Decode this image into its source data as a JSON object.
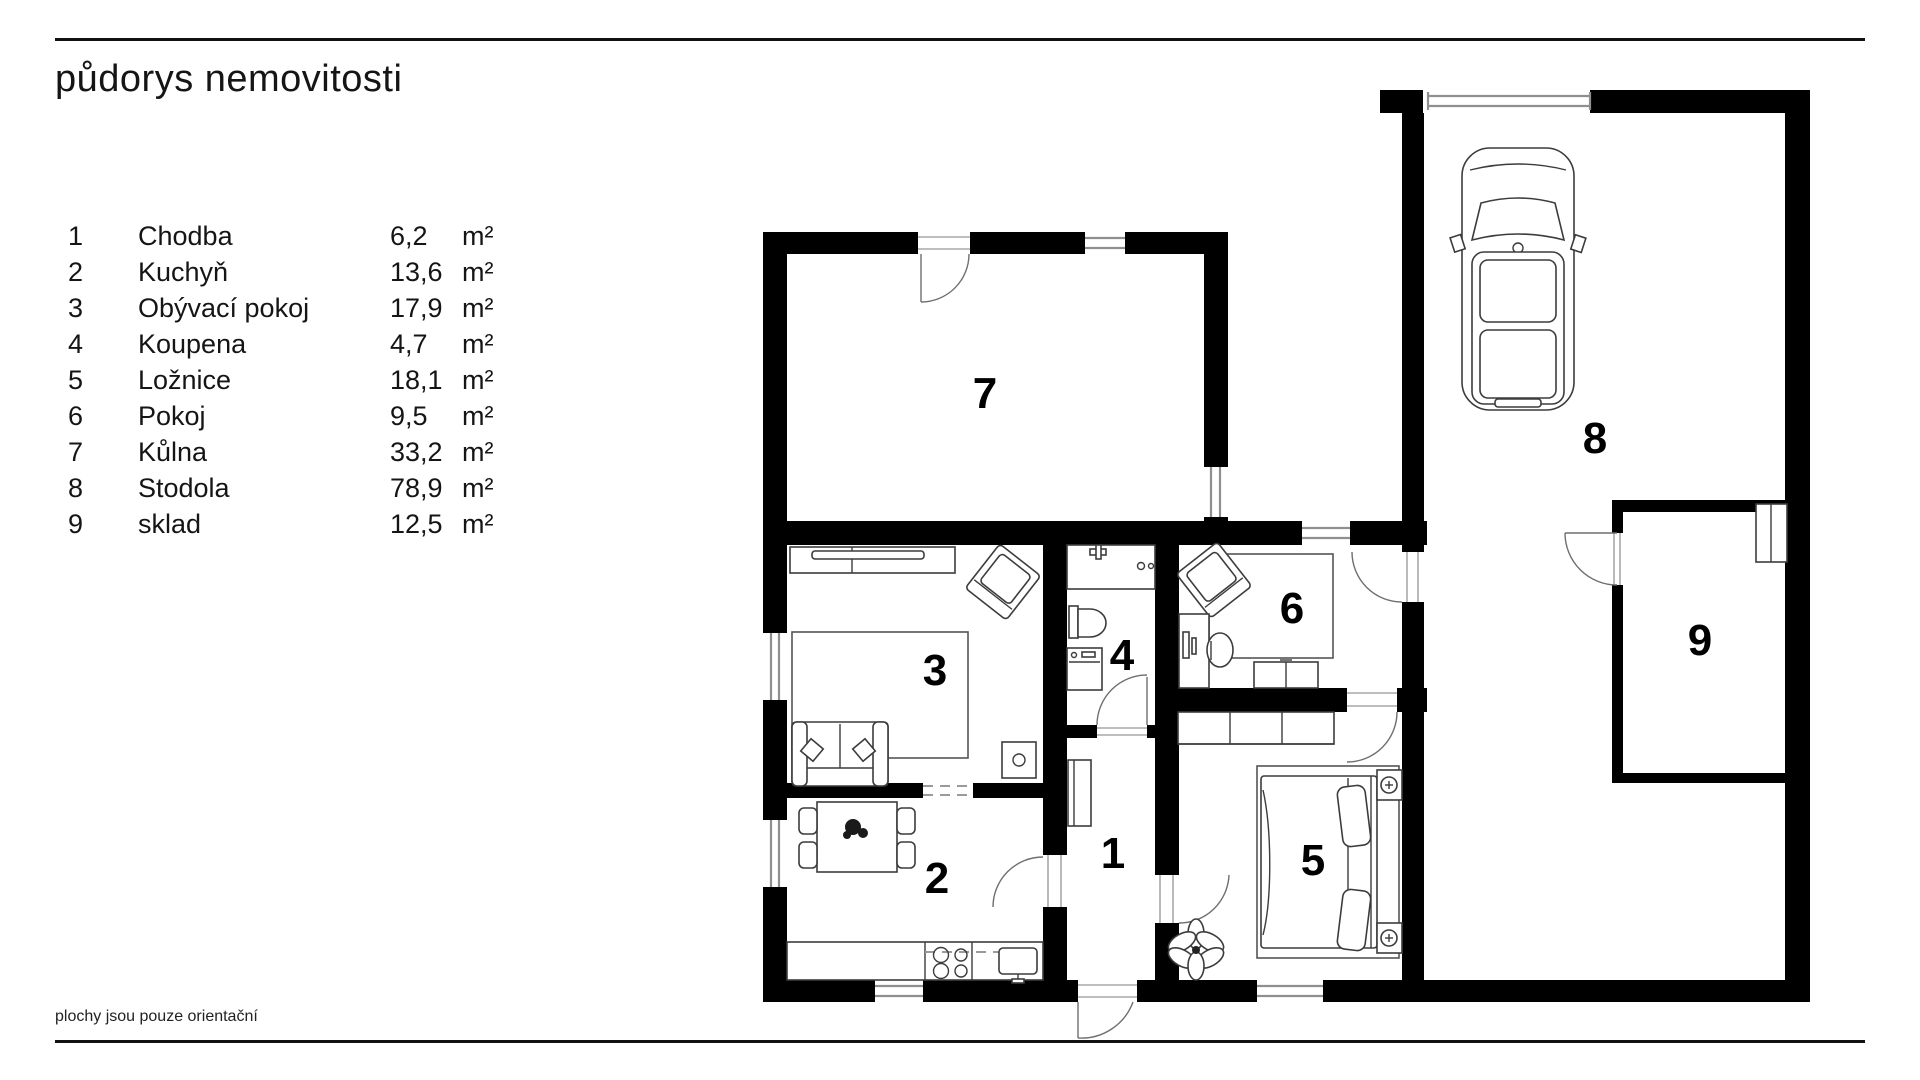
{
  "page": {
    "title": "půdorys nemovitosti",
    "footnote": "plochy jsou pouze orientační"
  },
  "legend": {
    "rows": [
      {
        "num": "1",
        "name": "Chodba",
        "area": "6,2",
        "unit": "m²"
      },
      {
        "num": "2",
        "name": "Kuchyň",
        "area": "13,6",
        "unit": "m²"
      },
      {
        "num": "3",
        "name": "Obývací pokoj",
        "area": "17,9",
        "unit": "m²"
      },
      {
        "num": "4",
        "name": "Koupena",
        "area": "4,7",
        "unit": "m²"
      },
      {
        "num": "5",
        "name": "Ložnice",
        "area": "18,1",
        "unit": "m²"
      },
      {
        "num": "6",
        "name": "Pokoj",
        "area": "9,5",
        "unit": "m²"
      },
      {
        "num": "7",
        "name": "Kůlna",
        "area": "33,2",
        "unit": "m²"
      },
      {
        "num": "8",
        "name": "Stodola",
        "area": "78,9",
        "unit": "m²"
      },
      {
        "num": "9",
        "name": "sklad",
        "area": "12,5",
        "unit": "m²"
      }
    ]
  },
  "plan": {
    "rooms": [
      {
        "number": "1",
        "name": "Chodba"
      },
      {
        "number": "2",
        "name": "Kuchyň"
      },
      {
        "number": "3",
        "name": "Obývací pokoj"
      },
      {
        "number": "4",
        "name": "Koupena"
      },
      {
        "number": "5",
        "name": "Ložnice"
      },
      {
        "number": "6",
        "name": "Pokoj"
      },
      {
        "number": "7",
        "name": "Kůlna"
      },
      {
        "number": "8",
        "name": "Stodola"
      },
      {
        "number": "9",
        "name": "sklad"
      }
    ]
  },
  "colors": {
    "wall": "#000000",
    "window": "#8f8f8f",
    "text": "#151515"
  }
}
